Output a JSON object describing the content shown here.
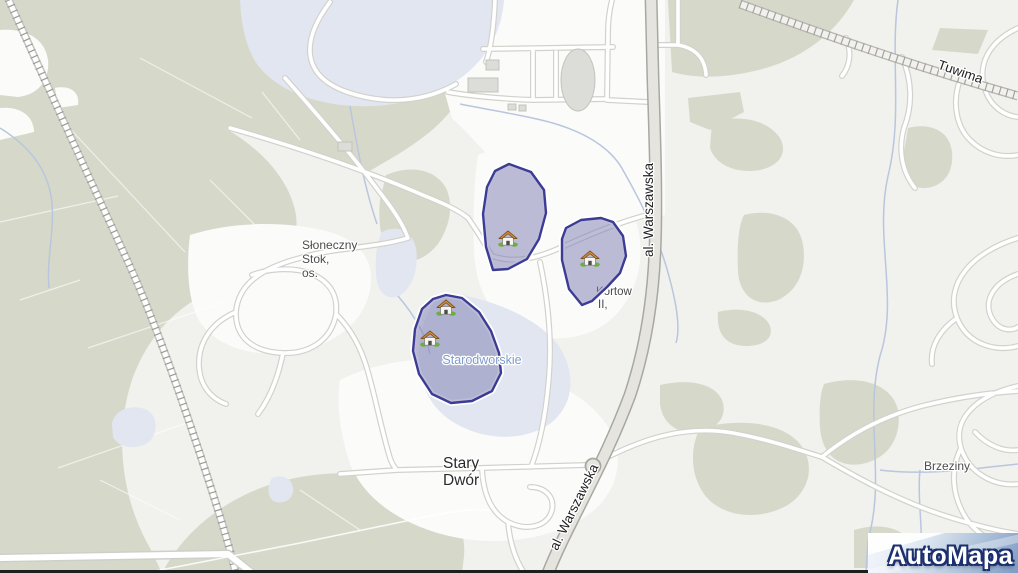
{
  "watermark": {
    "brand": "AutoMapa"
  },
  "labels": {
    "sloneczny1": "Słoneczny",
    "sloneczny2": "Stok,",
    "sloneczny3": "os.",
    "stary1": "Stary",
    "stary2": "Dwór",
    "brzeziny": "Brzeziny",
    "starodworskie": "Starodworskie",
    "kortow1": "Kortow",
    "kortow2": "II,",
    "warszawska_top": "al. Warszawska",
    "warszawska_bottom": "al. Warszawska",
    "tuwima": "Tuwima"
  },
  "zones": {
    "north": "allotment-zone-north",
    "east": "allotment-zone-east",
    "starodworskie": "allotment-zone-starodworskie"
  },
  "markers": {
    "house_count": 4,
    "house_icon": "allotment-house-icon"
  },
  "colors": {
    "forest": "#d6d9ca",
    "urban_base": "#f1f1ee",
    "open_white": "#fbfbf9",
    "water": "#e2e6f1",
    "stream": "#b9c6dd",
    "road_fill": "#ffffff",
    "road_casing": "#d2d2cc",
    "major_road_fill": "#e6e4de",
    "major_road_casing": "#a8a8a2",
    "railway_tie": "#9a9a95",
    "zone_fill": "#7b7bb2",
    "zone_border": "#3c3c94",
    "label_dark": "#2b2b2b",
    "label_gray": "#4d4d4d",
    "water_label": "#7e9bca",
    "brand_navy": "#1c2f6e"
  }
}
